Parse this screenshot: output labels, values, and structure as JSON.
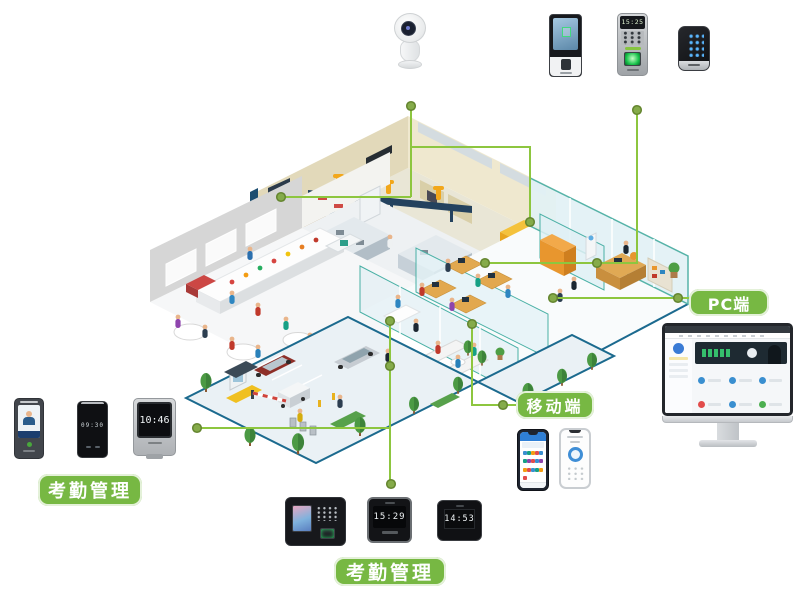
{
  "labels": {
    "attendance_left": "考勤管理",
    "attendance_bottom": "考勤管理",
    "mobile": "移动端",
    "pc": "PC端"
  },
  "devices": {
    "camera": {
      "type": "ptz-security-camera"
    },
    "face_terminal": {
      "type": "face-recognition-terminal"
    },
    "fingerprint_terminal": {
      "type": "fingerprint-access-terminal",
      "time": "15:25"
    },
    "keypad_terminal": {
      "type": "touch-keypad-access-terminal"
    },
    "left_group": [
      {
        "type": "face-attendance-terminal"
      },
      {
        "type": "slim-attendance-terminal",
        "time": "09:30"
      },
      {
        "type": "desktop-attendance-terminal",
        "time": "10:46"
      }
    ],
    "bottom_group": [
      {
        "type": "keypad-attendance-machine"
      },
      {
        "type": "clock-attendance-terminal",
        "time": "15:29"
      },
      {
        "type": "clock-attendance-terminal",
        "time": "14:53"
      }
    ],
    "phones": [
      {
        "type": "mobile-app-grid-phone"
      },
      {
        "type": "mobile-clock-in-phone"
      }
    ],
    "monitor": {
      "type": "pc-dashboard-monitor"
    }
  },
  "colors": {
    "label_green": "#77b843",
    "line_green": "#8dc63f",
    "node_green": "#85ab4a"
  }
}
